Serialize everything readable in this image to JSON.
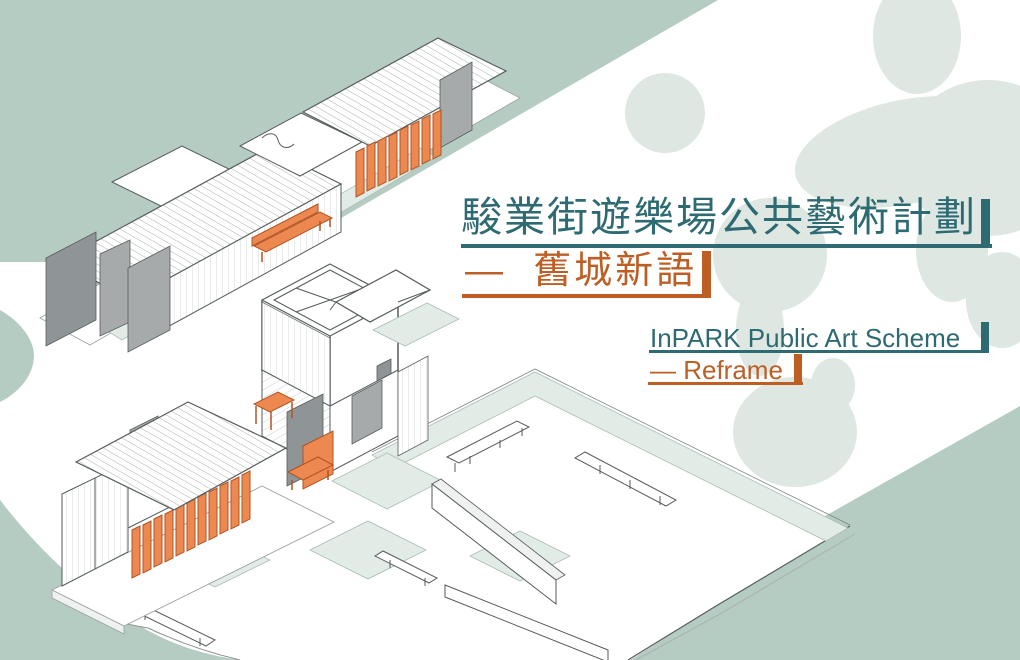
{
  "poster": {
    "title_zh": "駿業街遊樂場公共藝術計劃",
    "subtitle_zh": "—  舊城新語",
    "title_en": "InPARK Public Art Scheme",
    "subtitle_en": "— Reframe"
  },
  "colors": {
    "teal": "#2d6a71",
    "orange": "#bd5f24",
    "orange_fill": "#ed8950",
    "orange_dark": "#b05322",
    "sage": "#b5ccc3",
    "blob": "#dee7e2",
    "pale": "#e2ece6",
    "pale_edge": "#aebcb5",
    "line": "#565b5c",
    "gray_panel": "#a6aaab",
    "gray_dark": "#8f9496"
  },
  "illustration": {
    "description": "isometric drawing of InPARK container structures",
    "elements": [
      "container-row",
      "floating-canopy",
      "watch-tower",
      "louver-container",
      "plaza",
      "benches",
      "orange-furniture"
    ]
  }
}
